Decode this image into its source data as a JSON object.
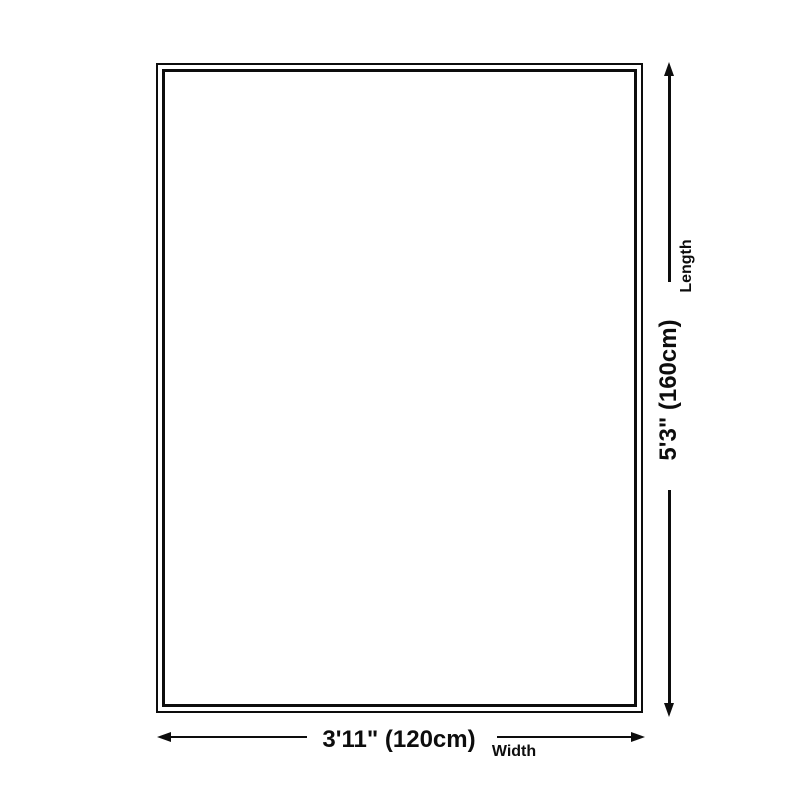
{
  "diagram": {
    "type": "product-dimension-diagram",
    "background_color": "#ffffff",
    "line_color": "#0d0d0d",
    "length": {
      "value": "5'3\" (160cm)",
      "label": "Length",
      "cm": 160,
      "feet_inches": "5'3\""
    },
    "width": {
      "value": "3'11\" (120cm)",
      "label": "Width",
      "cm": 120,
      "feet_inches": "3'11\""
    }
  }
}
